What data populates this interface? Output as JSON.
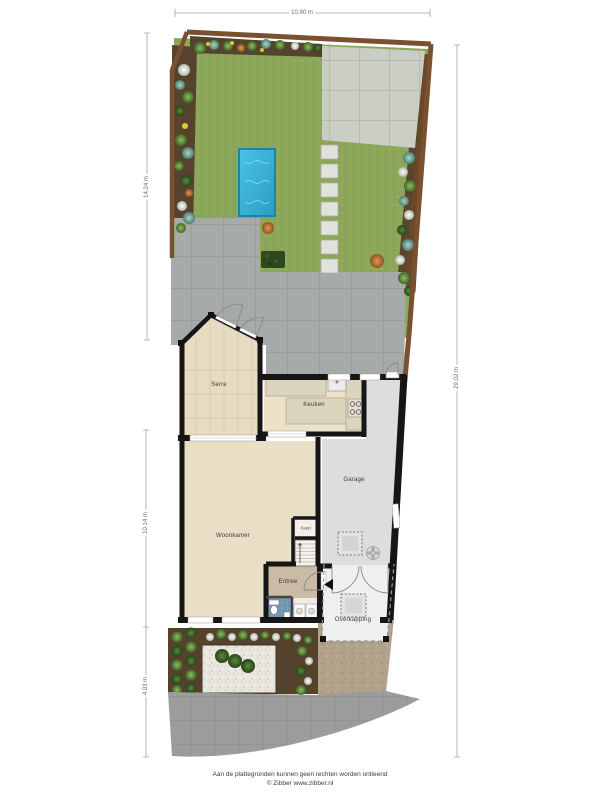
{
  "dimensions": {
    "top": "10.80 m",
    "garden_left": "14.24 m",
    "house_left": "10.14 m",
    "front_left": "4.93 m",
    "total_right": "29.02 m"
  },
  "rooms": {
    "serre": "Serre",
    "keuken": "Keuken",
    "woonkamer": "Woonkamer",
    "kast": "Kast",
    "garage": "Garage",
    "entree": "Entree",
    "overkapping": "Overkapping"
  },
  "footer": {
    "disclaimer": "Aan de plattegronden kunnen geen rechten worden ontleend",
    "credit": "© Zibber www.zibber.nl"
  },
  "colors": {
    "grass": "#8da75a",
    "pool_water": "#3fb6dc",
    "wall": "#161616",
    "living_floor": "#e9dfc6",
    "garage_floor": "#dddddd",
    "terrace": "#a6aba9",
    "fence": "#7a5130"
  }
}
